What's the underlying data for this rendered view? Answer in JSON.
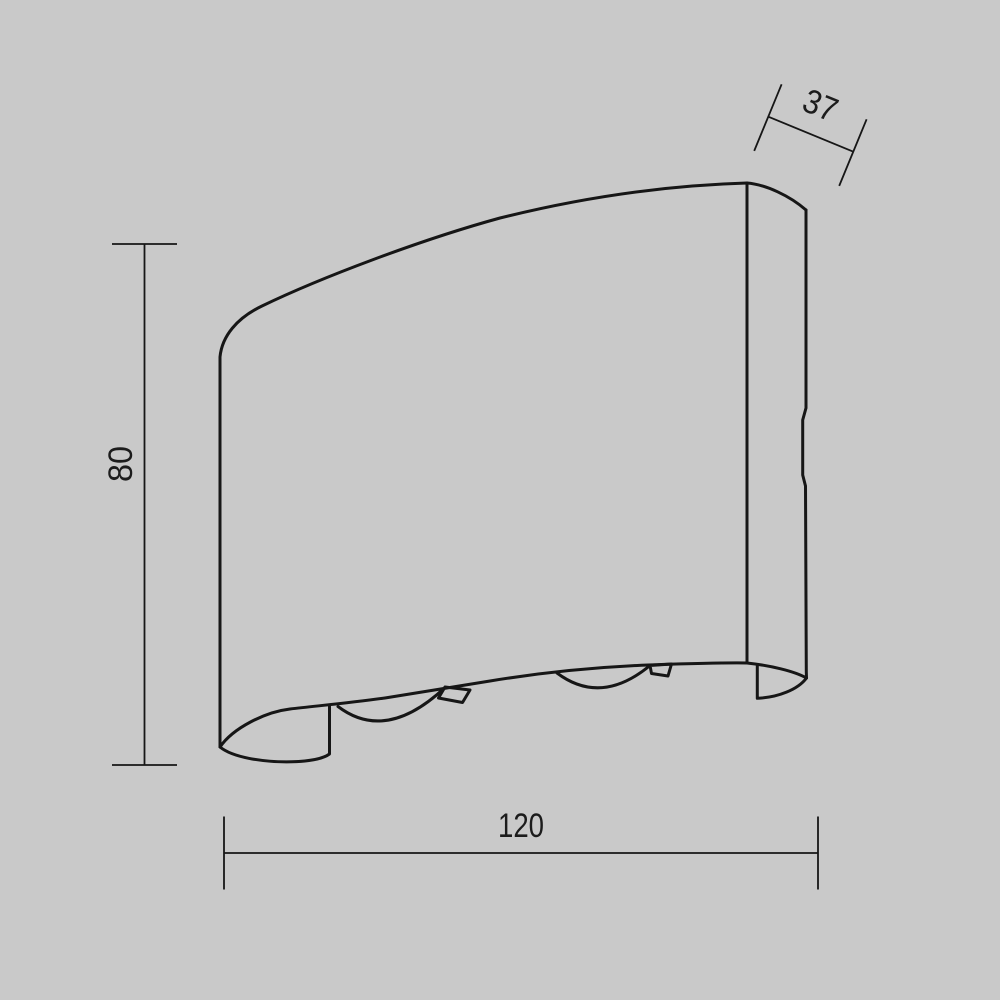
{
  "colors": {
    "background": "#c9c9c9",
    "line": "#161616",
    "text": "#1c1c1c"
  },
  "drawing": {
    "subject": "wall-lamp-side-projection",
    "dimensions": {
      "height": {
        "label": "80"
      },
      "width": {
        "label": "120"
      },
      "depth": {
        "label": "37"
      }
    }
  }
}
